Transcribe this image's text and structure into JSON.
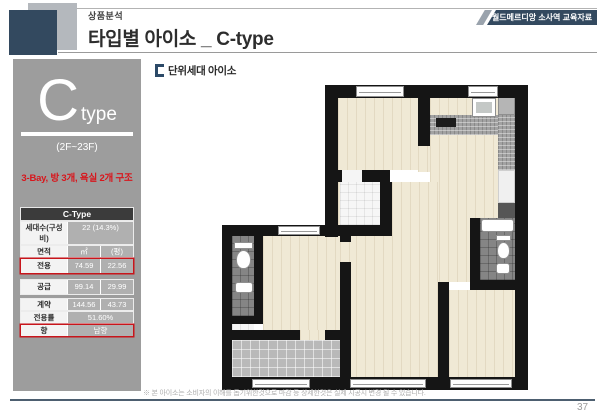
{
  "header": {
    "eyebrow": "상품분석",
    "title": "타입별 아이소 _ C-type",
    "badge": "월드메르디앙 소사역 교육자료"
  },
  "sidebar": {
    "type_letter": "C",
    "type_suffix": "type",
    "floor_range": "(2F~23F)",
    "structure_note": "3-Bay, 방 3개, 욕실 2개 구조",
    "table": {
      "title": "C-Type",
      "rows": [
        {
          "label": "세대수(구성비)",
          "value": "22 (14.3%)"
        },
        {
          "label": "면적",
          "v1": "㎡",
          "v2": "(평)"
        },
        {
          "label": "전용",
          "v1": "74.59",
          "v2": "22.56"
        },
        {
          "label": "공급",
          "v1": "99.14",
          "v2": "29.99"
        },
        {
          "label": "계약",
          "v1": "144.56",
          "v2": "43.73"
        },
        {
          "label": "전용률",
          "value": "51.60%"
        },
        {
          "label": "향",
          "value": "남향"
        }
      ]
    }
  },
  "main": {
    "section_label": "단위세대 아이소",
    "footnote": "※ 본 아이소는 소비자의 이해를 돕기위한것으로 마감 등 상세한것은 실제 시공시 변경 될 수 있습니다.",
    "page_number": "37"
  },
  "colors": {
    "navy": "#33495f",
    "accent_red": "#c8151b",
    "sidebar_gray": "#9d9d9d",
    "wall_black": "#151515",
    "wood_floor": "#f0e9d5"
  }
}
